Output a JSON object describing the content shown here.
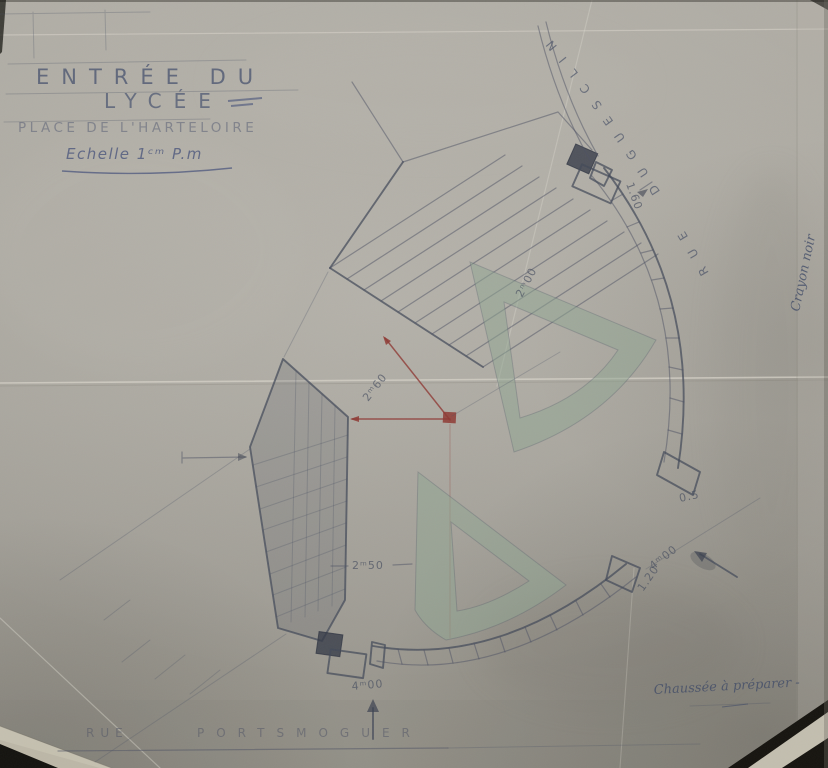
{
  "title": {
    "line1": "ENTRÉE DU",
    "line2": "LYCÉE",
    "line3": "PLACE DE L'HARTELOIRE",
    "scale_label": "Echelle 1ᶜᵐ P.m"
  },
  "streets": {
    "top_right": "RUE DUGUESCLIN",
    "bottom_word1": "RUE",
    "bottom_word2": "PORTSMOGUER"
  },
  "dimensions": {
    "top_gate": "1.60",
    "upper_walk": "2ᵐ00",
    "red_diagonal": "2ᵐ60",
    "left_wall": "2ᵐ50",
    "bottom_gate": "4ᵐ00",
    "right_roadway": "4ᵐ00",
    "lower_curb_end": "1.20",
    "upper_curb_end": "0.5"
  },
  "notes": {
    "bottom_right": "Chaussée à préparer -",
    "side_rotated": "Crayon noir"
  },
  "colors": {
    "paper": "#aba8a0",
    "pencil": "#4d5264",
    "ink": "#41507a",
    "red_line": "#8e3a34",
    "island_green": "#8fa591",
    "photo_backing": "#16140f"
  }
}
